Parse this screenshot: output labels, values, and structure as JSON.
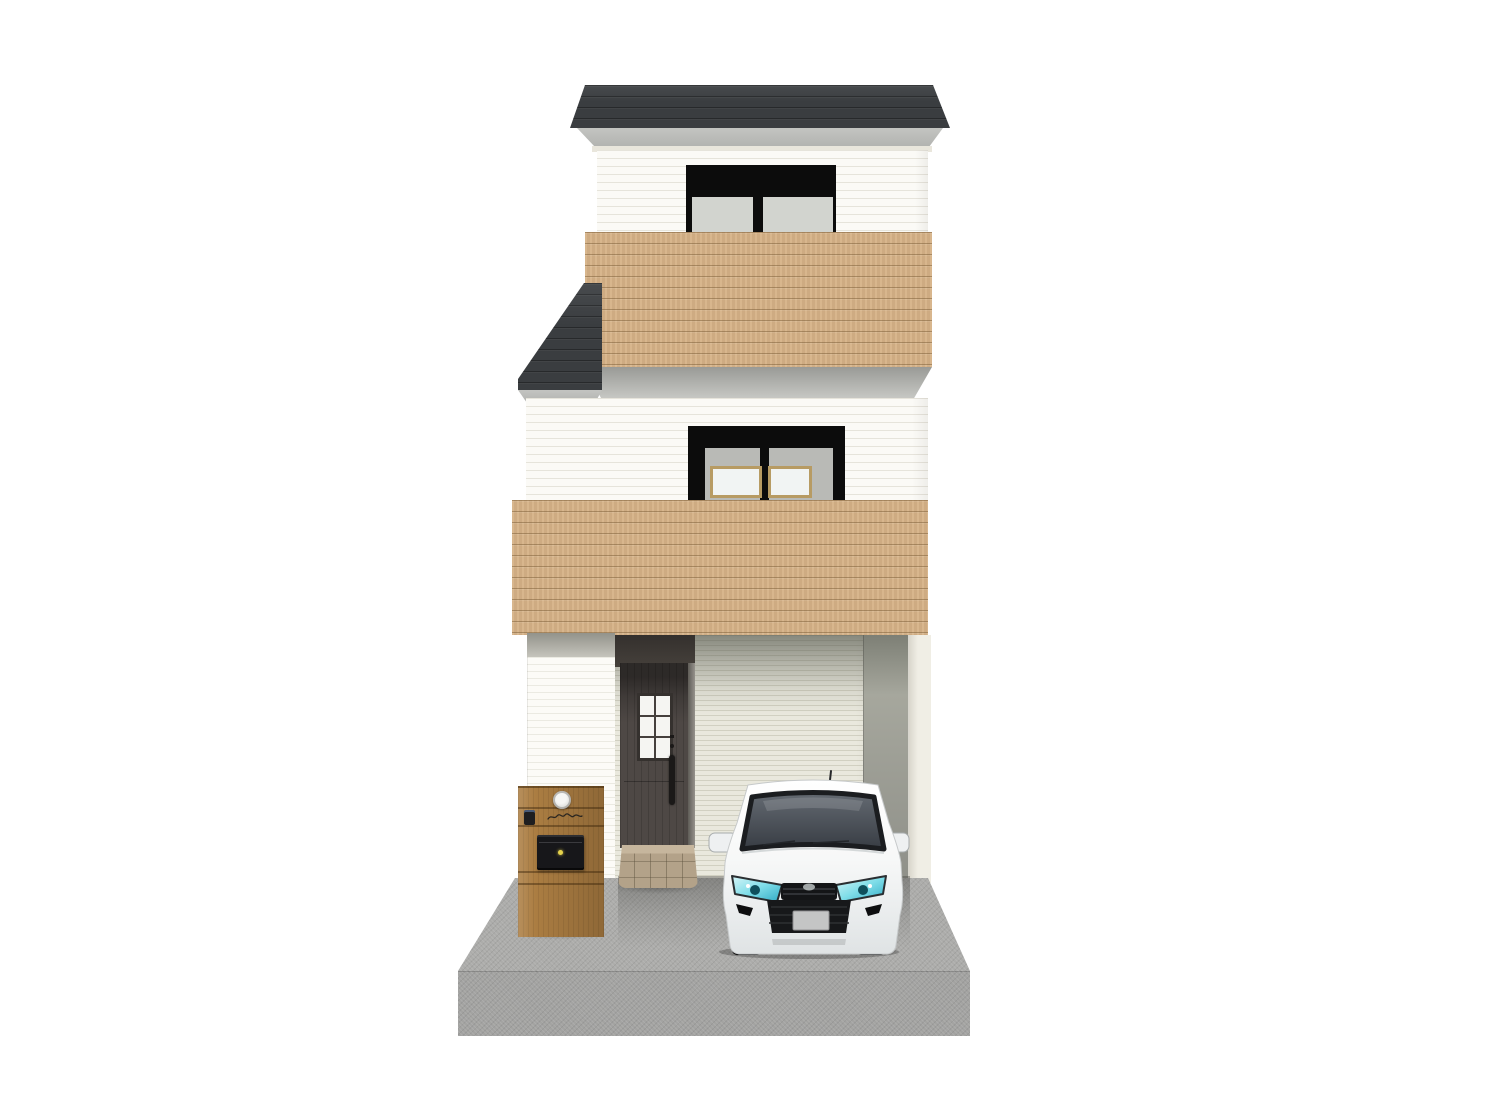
{
  "scene": {
    "type": "3d-architectural-rendering",
    "description": "Front elevation of a narrow three-story house with wood-clad balconies, an integrated carport with a white compact car, entrance door, tiled step and wooden mailbox post on a concrete driveway",
    "background_color": "#ffffff"
  },
  "palette": {
    "bg": "#ffffff",
    "roof-dark": "#3a3d40",
    "fascia-gray": "#b2b3b0",
    "fascia-light": "#c3c4c1",
    "trim-cream": "#e9e6dc",
    "wall-white": "#fbfaf6",
    "wood": "#d6b287",
    "underband-dark": "#999a96",
    "underband-light": "#c9cac6",
    "window-frame-black": "#0c0c0c",
    "pane-gray": "#d2d4cf",
    "pane-light": "#f1f4f3",
    "window-surround": "#b9bab6",
    "window-frame-tan": "#b79b63",
    "garage-wall": "#e9e8dd",
    "garage-side": "#a6a79d",
    "garage-side-dark": "#7d7f75",
    "corner-trim": "#f0eee5",
    "door-brown": "#4e4845",
    "door-glass": "#f5f5f2",
    "handle-black": "#1b1918",
    "step-tan": "#b3a289",
    "step-top": "#c6b69d",
    "post-wood": "#ab7d42",
    "mailbox-black": "#17171a",
    "keyhole-gold": "#e6d34c",
    "concrete-top": "#acacaa",
    "concrete-front": "#a3a3a1",
    "car-body": "#f7f8f8",
    "car-glass-top": "#646a72",
    "car-glass-bottom": "#383d44",
    "headlight-cyan": "#7fdde8",
    "headlight-deep": "#2fa9c4",
    "grille-black": "#141517",
    "plate-gray": "#c4c5c5"
  },
  "house": {
    "floors": 3,
    "roof_color": "#3a3d40",
    "siding_color": "#fbfaf6",
    "balcony_wood_color": "#d6b287",
    "third_floor_window": "two-pane slider, black frame, gray glass",
    "second_floor_window": "two-pane slider, black header, tan inner sashes",
    "door": {
      "color": "#4e4845",
      "glass_panes": 6,
      "handle_color": "#1b1918"
    }
  },
  "exterior": {
    "mailbox_post_color": "#ab7d42",
    "mailbox_color": "#17171a",
    "mailbox_keyhole_color": "#e6d34c",
    "entrance_step": "tan tiled block",
    "driveway_color": "#acacaa"
  },
  "car": {
    "type": "compact hatchback, front view",
    "body_color": "#f7f8f8",
    "glass_color": "#383d44",
    "headlight_color": "#7fdde8",
    "grille_color": "#141517",
    "license_plate_color": "#c4c5c5",
    "features": [
      "roof antenna",
      "two side mirrors",
      "lower black bumper intake",
      "license plate"
    ]
  }
}
